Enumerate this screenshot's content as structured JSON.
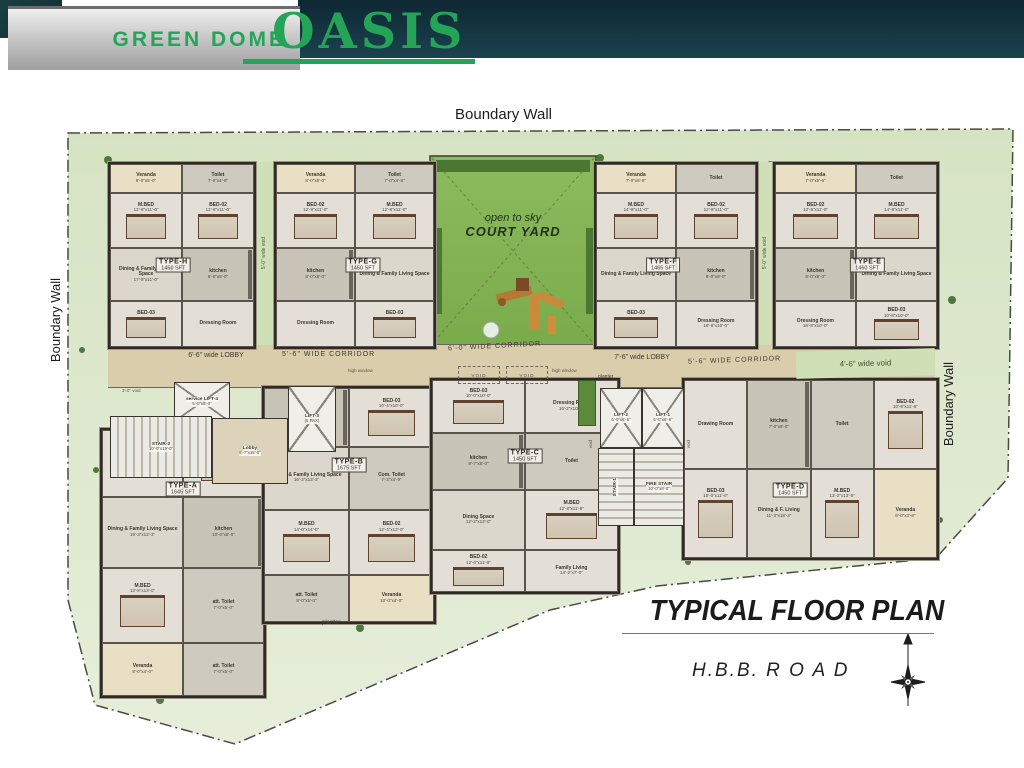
{
  "header": {
    "brand": "GREEN DOME",
    "project": "OASIS"
  },
  "site": {
    "boundary_wall_top": "Boundary Wall",
    "boundary_wall_left": "Boundary Wall",
    "boundary_wall_right": "Boundary Wall",
    "courtyard": {
      "line1": "open to sky",
      "line2": "COURT YARD"
    },
    "title": "TYPICAL FLOOR PLAN",
    "road": "H.B.B. R O A D"
  },
  "corridors": {
    "lobby_left": "6'-6\" wide LOBBY",
    "corridor_left": "5'-6\" WIDE CORRIDOR",
    "corridor_center": "6'-0\" WIDE CORRIDOR",
    "lobby_center": "7'-6\" wide LOBBY",
    "corridor_right": "5'-6\" WIDE CORRIDOR",
    "void_right": "4'-6\" wide void",
    "void_top": "5'-0\" wide void",
    "void_mid": "4'-0\" wide void",
    "void_small": "3'-0\" void",
    "void_box": "VOID",
    "void_tiny": "void",
    "planter": "planter",
    "high_window": "high window"
  },
  "core": {
    "lift4": {
      "n": "service LIFT-4",
      "d": "5'-0\"x5'-0\""
    },
    "stair2": {
      "n": "STAIR-2",
      "d": "10'-0\"x19'-0\""
    },
    "lobby": {
      "n": "Lobby",
      "d": "8'-7\"x15'-0\""
    },
    "lift3": {
      "n": "LIFT-3",
      "d": "(6 PAX)"
    },
    "lift2": {
      "n": "LIFT-2",
      "d": "6'-0\"x6'-6\""
    },
    "lift1": {
      "n": "LIFT-1",
      "d": "6'-0\"x6'-6\""
    },
    "stair1": {
      "n": "STAIR-1",
      "d": ""
    },
    "firestair": {
      "n": "FIRE STAIR",
      "d": "10'-0\"x8'-0\""
    }
  },
  "units": [
    {
      "id": "h",
      "name": "TYPE-H",
      "area": "1450 SFT",
      "rooms": [
        {
          "n": "Veranda",
          "d": "8'-0\"x5'-0\"",
          "c": "ver"
        },
        {
          "n": "Toilet",
          "d": "7'-0\"x4'-8\"",
          "c": "toi"
        },
        {
          "n": "M.BED",
          "d": "12'-8\"x11'-0\"",
          "c": "bed"
        },
        {
          "n": "BED-02",
          "d": "12'-8\"x11'-0\"",
          "c": "bed"
        },
        {
          "n": "Dining & Family Living Space",
          "d": "17'-8\"x11'-0\"",
          "c": "din"
        },
        {
          "n": "kitchen",
          "d": "8'-0\"x8'-0\"",
          "c": "kit"
        },
        {
          "n": "BED-03",
          "d": "",
          "c": "bed"
        },
        {
          "n": "Dressing Room",
          "d": "",
          "c": ""
        }
      ]
    },
    {
      "id": "g",
      "name": "TYPE-G",
      "area": "1450 SFT",
      "rooms": [
        {
          "n": "Veranda",
          "d": "8'-0\"x5'-0\"",
          "c": "ver"
        },
        {
          "n": "Toilet",
          "d": "7'-0\"x4'-8\"",
          "c": "toi"
        },
        {
          "n": "BED-02",
          "d": "12'-8\"x11'-0\"",
          "c": "bed"
        },
        {
          "n": "M.BED",
          "d": "12'-8\"x11'-0\"",
          "c": "bed"
        },
        {
          "n": "kitchen",
          "d": "8'-0\"x8'-0\"",
          "c": "kit"
        },
        {
          "n": "Dining & Family Living Space",
          "d": "",
          "c": "din"
        },
        {
          "n": "Dressing Room",
          "d": "",
          "c": ""
        },
        {
          "n": "BED-03",
          "d": "",
          "c": "bed"
        }
      ]
    },
    {
      "id": "f",
      "name": "TYPE-F",
      "area": "1465 SFT",
      "rooms": [
        {
          "n": "Veranda",
          "d": "7'-0\"x5'-6\"",
          "c": "ver"
        },
        {
          "n": "Toilet",
          "d": "",
          "c": "toi"
        },
        {
          "n": "M.BED",
          "d": "14'-8\"x11'-0\"",
          "c": "bed"
        },
        {
          "n": "BED-02",
          "d": "12'-8\"x11'-0\"",
          "c": "bed"
        },
        {
          "n": "Dining & Family Living Space",
          "d": "",
          "c": "din"
        },
        {
          "n": "kitchen",
          "d": "8'-0\"x8'-0\"",
          "c": "kit"
        },
        {
          "n": "BED-03",
          "d": "",
          "c": "bed"
        },
        {
          "n": "Dressing Room",
          "d": "18'-8\"x10'-0\"",
          "c": ""
        }
      ]
    },
    {
      "id": "e",
      "name": "TYPE-E",
      "area": "1460 SFT",
      "rooms": [
        {
          "n": "Veranda",
          "d": "7'-0\"x5'-6\"",
          "c": "ver"
        },
        {
          "n": "Toilet",
          "d": "",
          "c": "toi"
        },
        {
          "n": "BED-02",
          "d": "12'-8\"x11'-0\"",
          "c": "bed"
        },
        {
          "n": "M.BED",
          "d": "14'-8\"x11'-0\"",
          "c": "bed"
        },
        {
          "n": "kitchen",
          "d": "8'-0\"x8'-0\"",
          "c": "kit"
        },
        {
          "n": "Dining & Family Living Space",
          "d": "",
          "c": "din"
        },
        {
          "n": "Dressing Room",
          "d": "18'-8\"x10'-0\"",
          "c": ""
        },
        {
          "n": "BED-03",
          "d": "10'-8\"x10'-0\"",
          "c": "bed"
        }
      ]
    },
    {
      "id": "a",
      "name": "TYPE-A",
      "area": "1645 SFT",
      "rooms": [
        {
          "n": "Dressing Room",
          "d": "15'-8\"x10'-7\"",
          "c": ""
        },
        {
          "n": "BED-03",
          "d": "",
          "c": "bed"
        },
        {
          "n": "Dining & Family Living Space",
          "d": "19'-3\"x13'-3\"",
          "c": "din"
        },
        {
          "n": "kitchen",
          "d": "10'-0\"x8'-0\"",
          "c": "kit"
        },
        {
          "n": "M.BED",
          "d": "13'-8\"x13'-0\"",
          "c": "bed"
        },
        {
          "n": "att. Toilet",
          "d": "7'-0\"x5'-0\"",
          "c": "toi"
        },
        {
          "n": "Veranda",
          "d": "8'-0\"x4'-0\"",
          "c": "ver"
        },
        {
          "n": "att. Toilet",
          "d": "7'-0\"x5'-0\"",
          "c": "toi"
        }
      ]
    },
    {
      "id": "b",
      "name": "TYPE-B",
      "area": "1675 SFT",
      "rooms": [
        {
          "n": "kitchen",
          "d": "",
          "c": "kit"
        },
        {
          "n": "BED-03",
          "d": "10'-4\"x10'-0\"",
          "c": "bed"
        },
        {
          "n": "Dining & Family Living Space",
          "d": "16'-2\"x13'-3\"",
          "c": "din"
        },
        {
          "n": "Com. Toilet",
          "d": "7'-3\"x4'-9\"",
          "c": "toi"
        },
        {
          "n": "M.BED",
          "d": "14'-0\"x14'-0\"",
          "c": "bed"
        },
        {
          "n": "BED-02",
          "d": "12'-4\"x13'-0\"",
          "c": "bed"
        },
        {
          "n": "att. Toilet",
          "d": "8'-0\"x5'-0\"",
          "c": "toi"
        },
        {
          "n": "Veranda",
          "d": "10'-0\"x4'-0\"",
          "c": "ver"
        }
      ]
    },
    {
      "id": "c",
      "name": "TYPE-C",
      "area": "1450 SFT",
      "rooms": [
        {
          "n": "BED-03",
          "d": "10'-0\"x10'-0\"",
          "c": "bed"
        },
        {
          "n": "Dressing Room",
          "d": "16'-2\"x10'-2\"",
          "c": ""
        },
        {
          "n": "kitchen",
          "d": "8'-7\"x8'-0\"",
          "c": "kit"
        },
        {
          "n": "Toilet",
          "d": "",
          "c": "toi"
        },
        {
          "n": "Dining Space",
          "d": "12'-2\"x13'-0\"",
          "c": "din"
        },
        {
          "n": "M.BED",
          "d": "12'-8\"x11'-8\"",
          "c": "bed"
        },
        {
          "n": "BED-02",
          "d": "12'-0\"x11'-8\"",
          "c": "bed"
        },
        {
          "n": "Family Living",
          "d": "14'-2\"x7'-0\"",
          "c": ""
        }
      ]
    },
    {
      "id": "d",
      "name": "TYPE-D",
      "area": "1450 SFT",
      "rooms": [
        {
          "n": "Drawing Room",
          "d": "",
          "c": ""
        },
        {
          "n": "kitchen",
          "d": "7'-0\"x8'-0\"",
          "c": "kit"
        },
        {
          "n": "Toilet",
          "d": "",
          "c": "toi"
        },
        {
          "n": "BED-02",
          "d": "10'-8\"x11'-8\"",
          "c": "bed"
        },
        {
          "n": "BED-03",
          "d": "10'-0\"x11'-0\"",
          "c": "bed"
        },
        {
          "n": "Dining & F. Living",
          "d": "11'-3\"x18'-3\"",
          "c": "din"
        },
        {
          "n": "M.BED",
          "d": "13'-2\"x13'-8\"",
          "c": "bed"
        },
        {
          "n": "Veranda",
          "d": "8'-0\"x3'-8\"",
          "c": "ver"
        }
      ]
    }
  ]
}
